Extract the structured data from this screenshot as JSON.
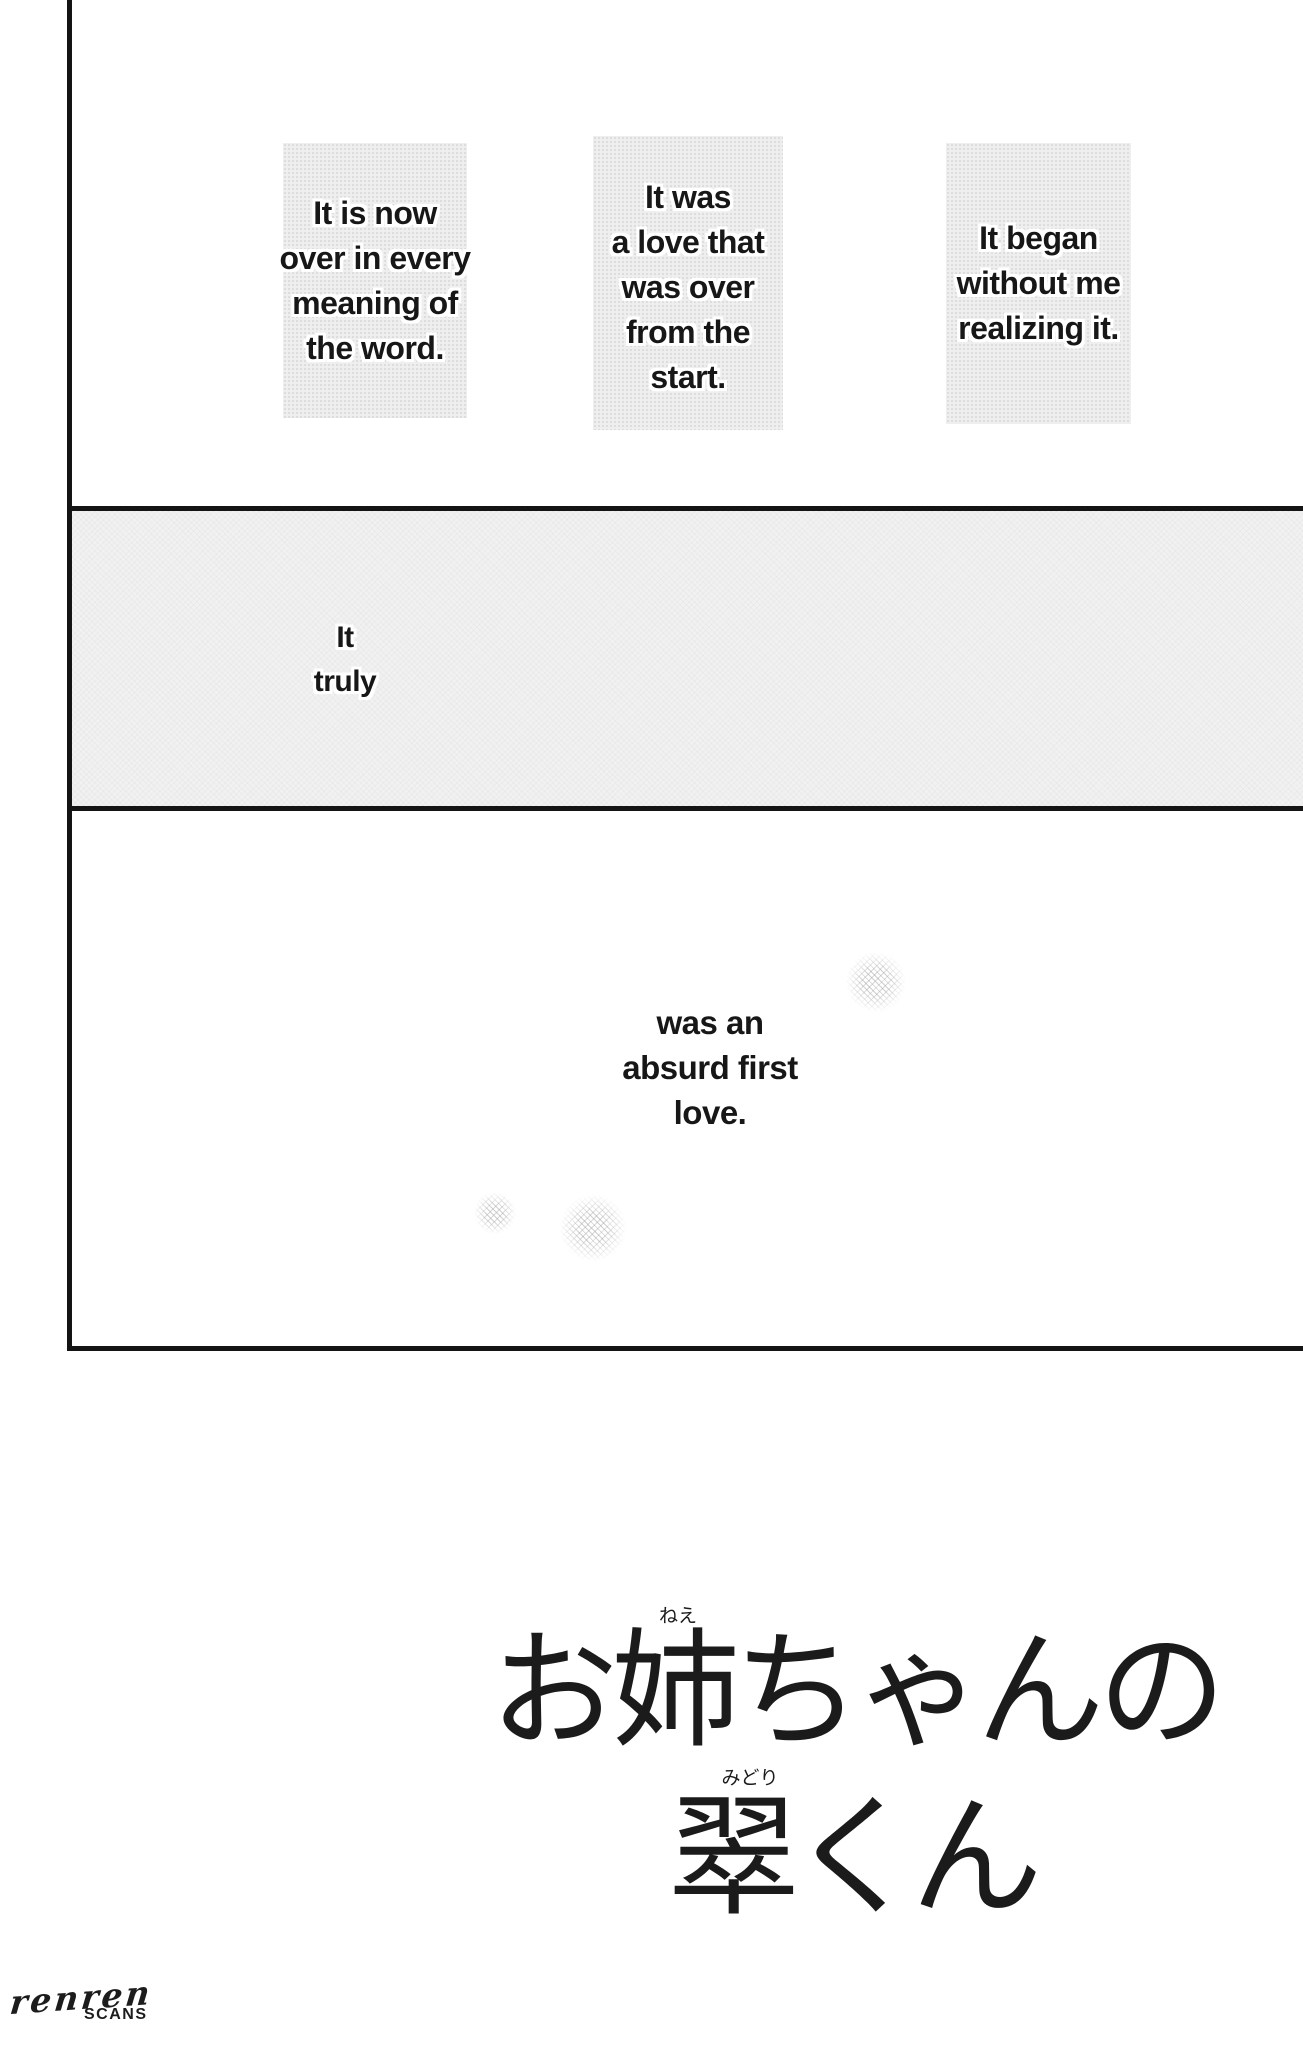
{
  "captions": {
    "boxes": [
      {
        "lines": [
          "It is now",
          "over in every",
          "meaning of",
          "the word."
        ]
      },
      {
        "lines": [
          "It was",
          "a love that",
          "was over",
          "from the",
          "start."
        ]
      },
      {
        "lines": [
          "It began",
          "without me",
          "realizing it."
        ]
      }
    ],
    "middle": {
      "lines": [
        "It",
        "truly"
      ]
    },
    "bottom": {
      "lines": [
        "was an",
        "absurd first",
        "love."
      ]
    }
  },
  "title": {
    "line1": "お姉ちゃんの",
    "line1_furigana": "ねえ",
    "line2": "翠くん",
    "line2_furigana": "みどり"
  },
  "credit": {
    "group_name": "renren",
    "group_label": "SCANS"
  },
  "colors": {
    "background": "#ffffff",
    "panel_border": "#141414",
    "screentone_fill": "#f1f1f1",
    "caption_box_fill": "#efefef",
    "text": "#171717"
  }
}
